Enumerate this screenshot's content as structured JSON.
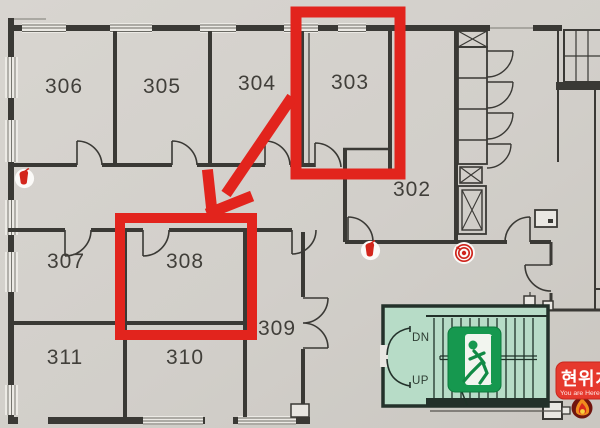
{
  "rooms": {
    "r306": {
      "label": "306"
    },
    "r305": {
      "label": "305"
    },
    "r304": {
      "label": "304"
    },
    "r303": {
      "label": "303"
    },
    "r302": {
      "label": "302"
    },
    "r307": {
      "label": "307"
    },
    "r308": {
      "label": "308"
    },
    "r309": {
      "label": "309"
    },
    "r310": {
      "label": "310"
    },
    "r311": {
      "label": "311"
    }
  },
  "stairwell": {
    "down": "DN",
    "up": "UP"
  },
  "location_badge": {
    "title": "현위치",
    "subtitle": "You are Here"
  },
  "annotations": {
    "highlighted_rooms": [
      "303",
      "308"
    ],
    "arrow": {
      "from_room": "303",
      "to_room": "308"
    },
    "highlight_color": "#e2241d"
  },
  "icons": [
    "exit-running-man-icon",
    "fire-extinguisher-icon",
    "fire-extinguisher-icon",
    "fire-hose-reel-icon",
    "flame-icon"
  ],
  "colors": {
    "background": "#d4d1cc",
    "walls": "#3a3935",
    "stair_fill": "#b7dcc7",
    "exit_sign_green": "#16984f",
    "badge_red": "#e6392d"
  }
}
